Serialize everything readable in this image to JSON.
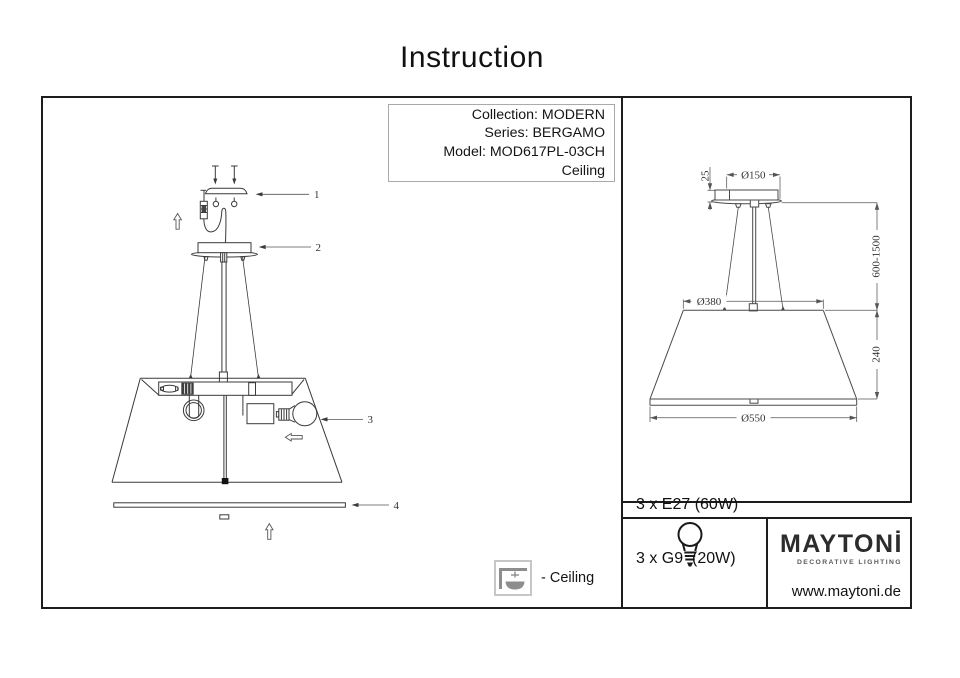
{
  "title": "Instruction",
  "product_info": {
    "collection": "Collection: MODERN",
    "series": "Series: BERGAMO",
    "model": "Model: MOD617PL-03CH",
    "mount_type": "Ceiling"
  },
  "assembly": {
    "parts": {
      "p1": "1",
      "p2": "2",
      "p3": "3",
      "p4": "4"
    }
  },
  "dimensions": {
    "canopy_diameter": "Ø150",
    "canopy_height": "25",
    "suspension_range": "600-1500",
    "shade_top_diameter": "Ø380",
    "shade_height": "240",
    "shade_bottom_diameter": "Ø550"
  },
  "legend": {
    "ceiling_label": "- Ceiling"
  },
  "specs": {
    "lamp_line1": "3 x E27 (60W)",
    "lamp_line2": "3 x G9  (20W)"
  },
  "brand": {
    "logo": "MAYTONİ",
    "tagline": "DECORATIVE LIGHTING",
    "website": "www.maytoni.de"
  },
  "colors": {
    "line": "#3a3a3a",
    "dimension_line": "#555555",
    "legend_gray": "#8d8d8d",
    "panel_border": "#1d1d1d"
  }
}
